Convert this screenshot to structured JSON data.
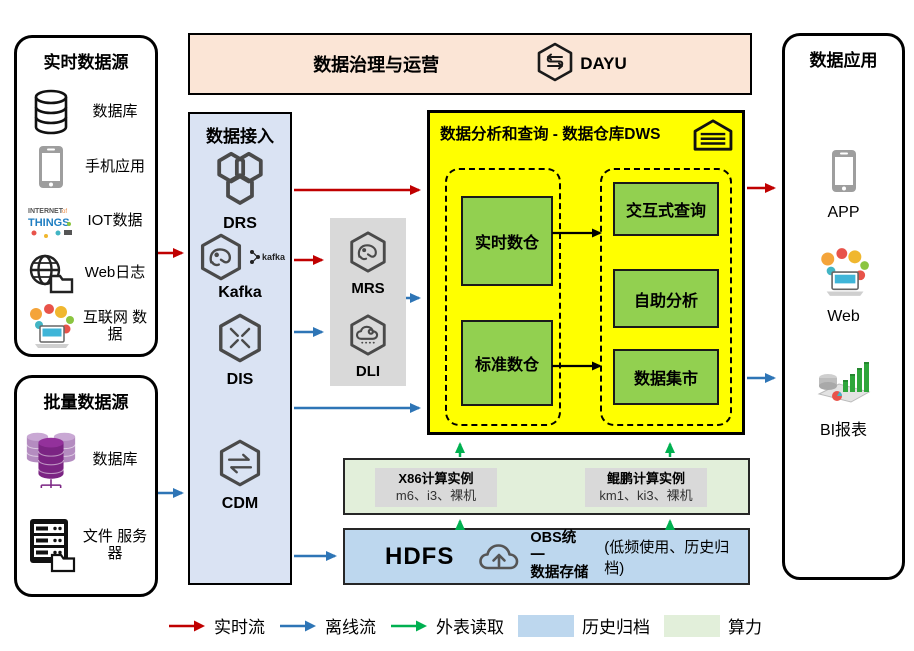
{
  "realtime_sources": {
    "title": "实时数据源",
    "items": [
      {
        "icon": "database-icon",
        "label": "数据库"
      },
      {
        "icon": "phone-icon",
        "label": "手机应用"
      },
      {
        "icon": "iot-icon",
        "label": "IOT数据"
      },
      {
        "icon": "web-log-icon",
        "label": "Web日志"
      },
      {
        "icon": "internet-icon",
        "label": "互联网 数据"
      }
    ]
  },
  "batch_sources": {
    "title": "批量数据源",
    "items": [
      {
        "icon": "purple-database-icon",
        "label": "数据库"
      },
      {
        "icon": "file-server-icon",
        "label": "文件 服务器"
      }
    ]
  },
  "governance": {
    "title": "数据治理与运营",
    "product_label": "DAYU"
  },
  "data_access": {
    "title": "数据接入",
    "items": [
      "DRS",
      "Kafka",
      "DIS",
      "CDM"
    ],
    "kafka_badge": "kafka"
  },
  "processing": {
    "items": [
      "MRS",
      "DLI"
    ]
  },
  "dws": {
    "title": "数据分析和查询 - 数据仓库DWS",
    "warehouses": [
      "实时数仓",
      "标准数仓"
    ],
    "services": [
      "交互式查询",
      "自助分析",
      "数据集市"
    ]
  },
  "apps": {
    "title": "数据应用",
    "items": [
      "APP",
      "Web",
      "BI报表"
    ]
  },
  "compute": {
    "instances": [
      {
        "name": "X86计算实例",
        "spec": "m6、i3、裸机"
      },
      {
        "name": "鲲鹏计算实例",
        "spec": "km1、ki3、裸机"
      }
    ]
  },
  "storage": {
    "hdfs_label": "HDFS",
    "obs_title_line1": "OBS统一",
    "obs_title_line2": "数据存储",
    "note": "(低频使用、历史归档)"
  },
  "legend": {
    "items": [
      {
        "kind": "arrow",
        "color": "#C00000",
        "label": "实时流"
      },
      {
        "kind": "arrow",
        "color": "#2E75B6",
        "label": "离线流"
      },
      {
        "kind": "arrow",
        "color": "#00B050",
        "label": "外表读取"
      },
      {
        "kind": "swatch",
        "color": "#BDD7EE",
        "label": "历史归档"
      },
      {
        "kind": "swatch",
        "color": "#E2EFDA",
        "label": "算力"
      }
    ]
  },
  "colors": {
    "dws_bg": "#FFFF00",
    "dws_module_green": "#92D050",
    "access_bg": "#DAE3F3",
    "governance_bg": "#FBE5D6",
    "compute_bg": "#E2EFDA",
    "storage_bg": "#BDD7EE",
    "processing_bg": "#D9D9D9"
  }
}
